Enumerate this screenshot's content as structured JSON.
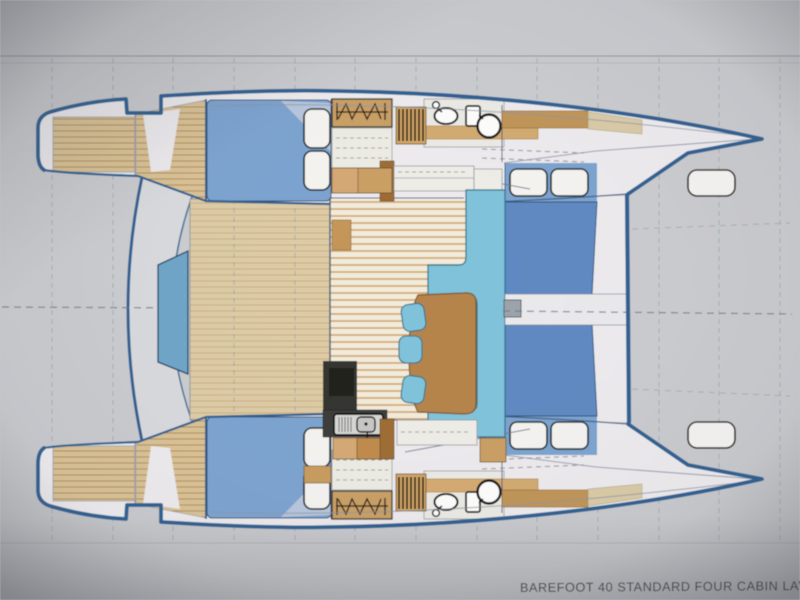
{
  "page": {
    "title": "BAREFOOT 40 STANDARD FOUR CABIN LAYOUT"
  },
  "diagram": {
    "type": "floor-plan",
    "subject": "catamaran four cabin layout, plan view, bows to the right"
  },
  "icons": [
    "toilet-icon",
    "sink-icon",
    "galley-sink-icon",
    "hanging-locker-icon",
    "stairs-icon",
    "mast-step",
    "foredeck-hatch"
  ],
  "colors": {
    "background": "#c9cacd",
    "hull_outline": "#2e5f90",
    "interior_white": "#eceaed",
    "deck_teak": "#d8c194",
    "deck_teak_line": "#b28a55",
    "cockpit_teak": "#dccba5",
    "cockpit_teak_line": "#c9ad7e",
    "salon_floor": "#f1ebdc",
    "salon_floor_line": "#d0a269",
    "settee_cyan": "#7fc2da",
    "settee_edge": "#2a6e8a",
    "bed_medium": "#7ba2cf",
    "bed_dark": "#5e88c1",
    "bed_wedge": "#bac4da",
    "seat_steel": "#6da4c8",
    "table_wood": "#b5834a",
    "table_edge": "#7d5426",
    "cabinet_wood": "#c99e63",
    "cabinet_light": "#d4a873",
    "cabinet_dark": "#bf8a4a",
    "counter_dark": "#32322f",
    "pillow_white": "#f4f3f0",
    "fixture_outline": "#101010",
    "gridline": "#8b94a6",
    "centerline": "#6f7786",
    "title_text": "#3a3a40"
  }
}
